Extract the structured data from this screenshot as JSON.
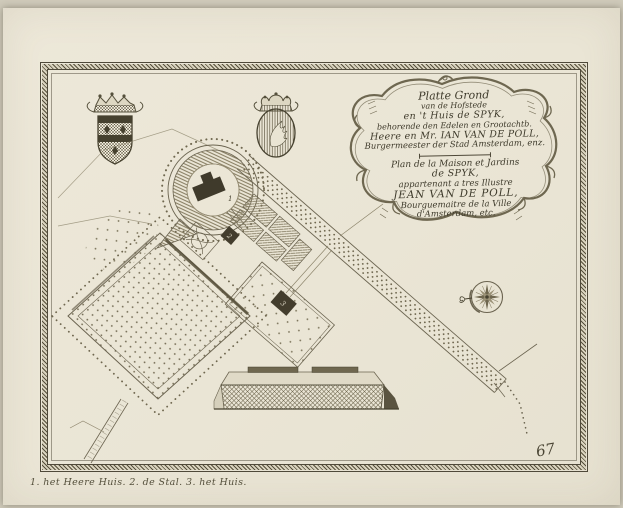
{
  "cartouche": {
    "dutch_lines": [
      "Platte Grond",
      "van de Hofstede",
      "en 't Huis de SPYK,",
      "behorende den Edelen en Grootachtb.",
      "Heere en Mr. IAN VAN DE POLL,",
      "Burgermeester der Stad Amsterdam, enz."
    ],
    "french_lines": [
      "Plan de la Maison et Jardins",
      "de SPYK,",
      "appartenant a tres Illustre",
      "JEAN VAN DE POLL,",
      "Bourguemaitre de la Ville",
      "d'Amsterdam, etc."
    ]
  },
  "map": {
    "labels": {
      "manor_house": "1",
      "stable": "2",
      "house": "3"
    },
    "plate_number": "67"
  },
  "caption": {
    "text": "1. het Heere Huis. 2. de Stal. 3. het Huis."
  },
  "colors": {
    "background": "#cfcaba",
    "paper": "#ebe6d6",
    "ink_dark": "#46412f",
    "ink_mid": "#6b6450",
    "ink_light": "#a29a80"
  },
  "icons": {
    "compass": "compass-rose-icon",
    "arms_left": "coat-of-arms-lozenges-icon",
    "arms_right": "coat-of-arms-wing-icon"
  }
}
